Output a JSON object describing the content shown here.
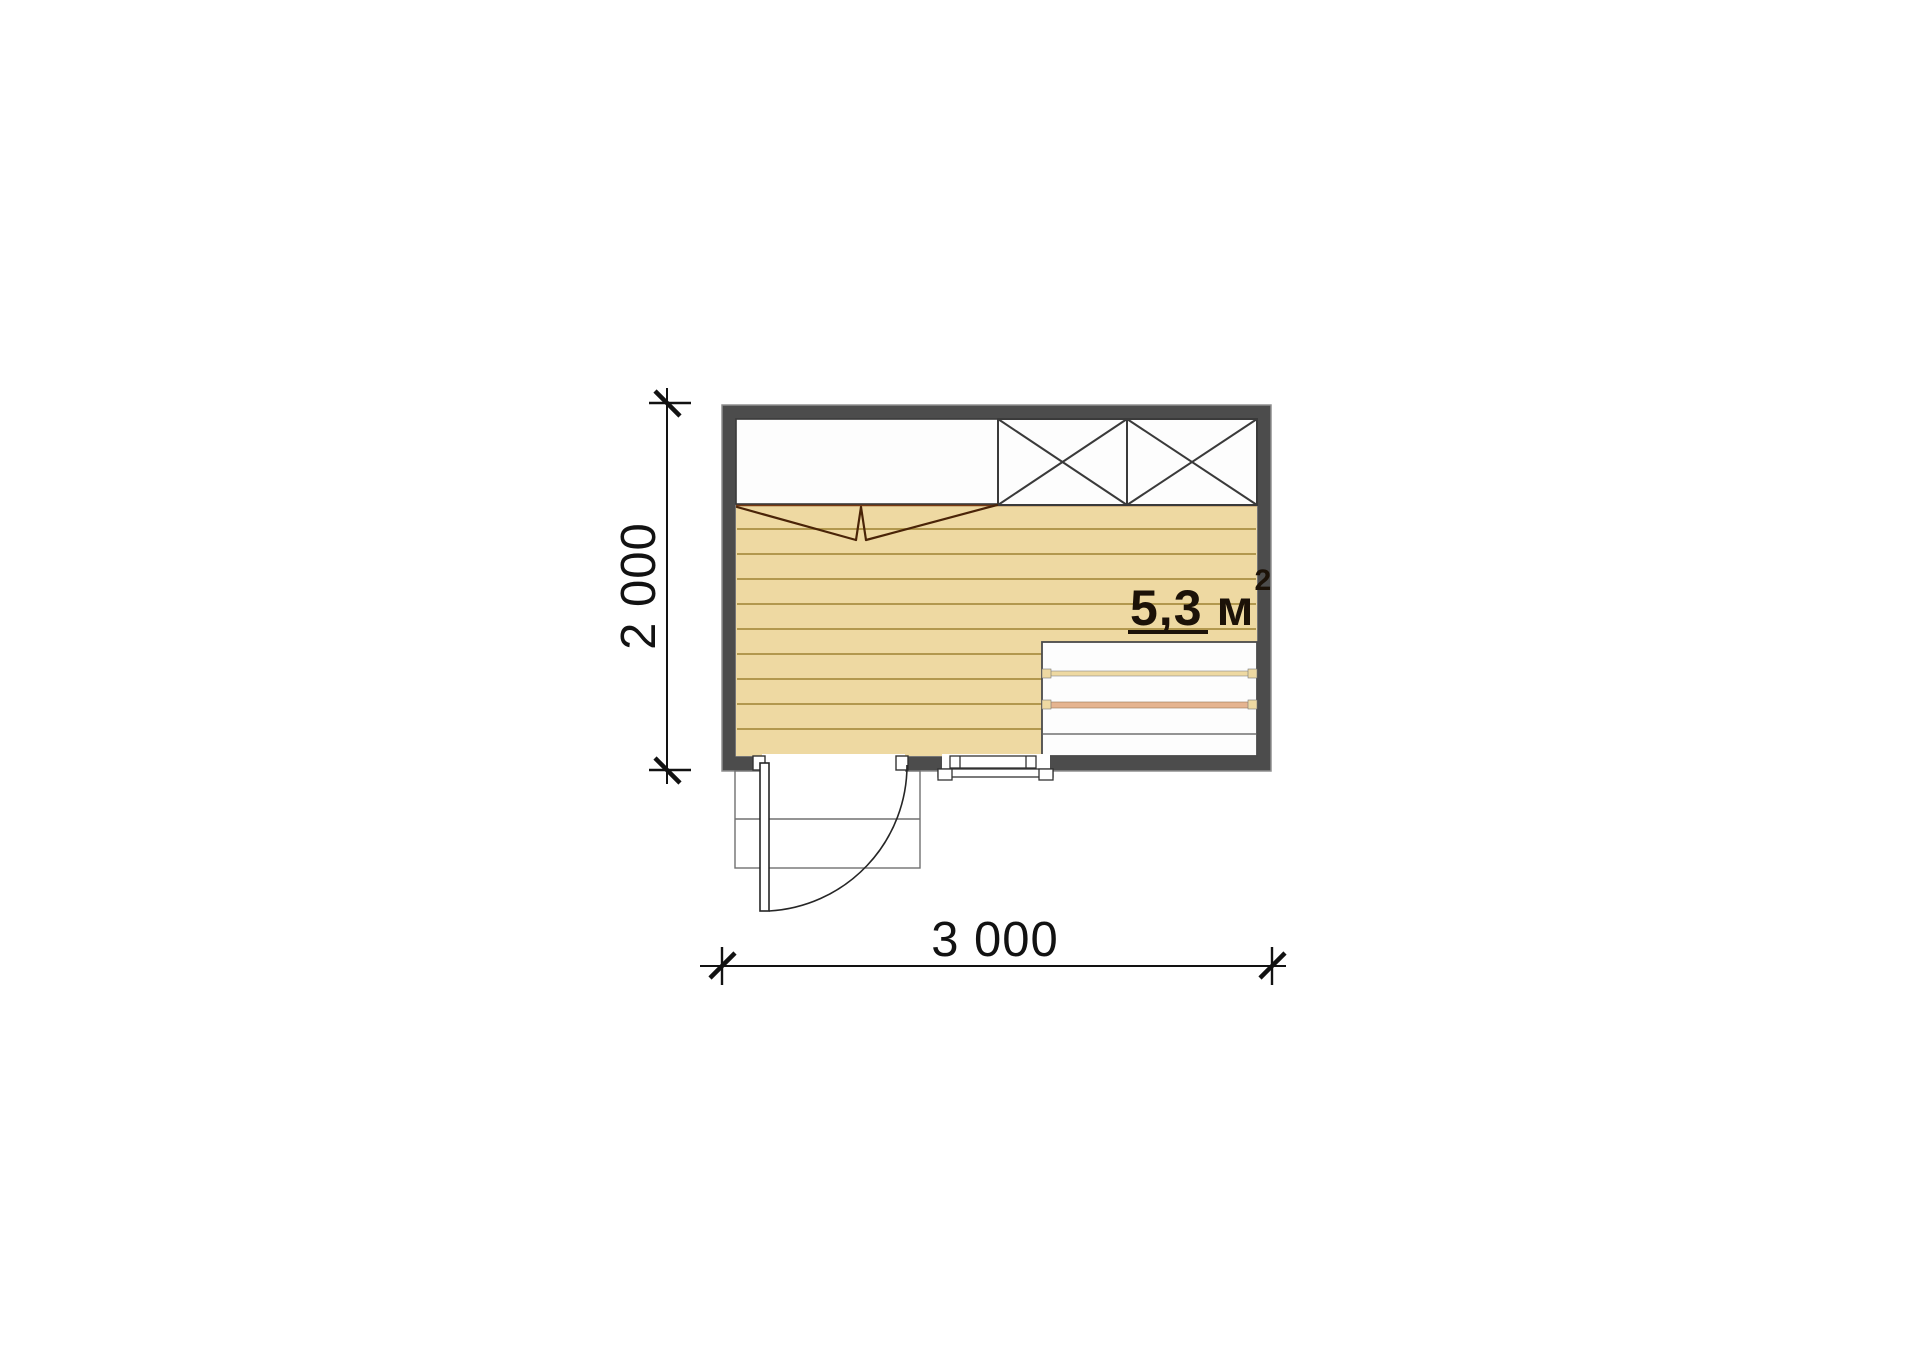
{
  "floor_plan": {
    "area_label": {
      "value": "5,3",
      "unit": "м",
      "exponent": "2"
    },
    "dimensions": {
      "horizontal": "3 000",
      "vertical": "2 000"
    },
    "colors": {
      "background": "#ffffff",
      "wall_fill": "#4c4c4c",
      "wall_outline": "#8f8f8f",
      "floor_fill": "#eed9a2",
      "plank_line": "#b2984e",
      "floor_edge_line": "#7a3a12",
      "fixture_line": "#3a3a3a",
      "bench_fill": "#fdfdfd",
      "bench_gap_warm": "#e5b490",
      "fold_mark_line": "#4a2408",
      "door_line": "#262626",
      "porch_line": "#707070",
      "dimension_line": "#121212",
      "label_text": "#1c1208"
    }
  }
}
